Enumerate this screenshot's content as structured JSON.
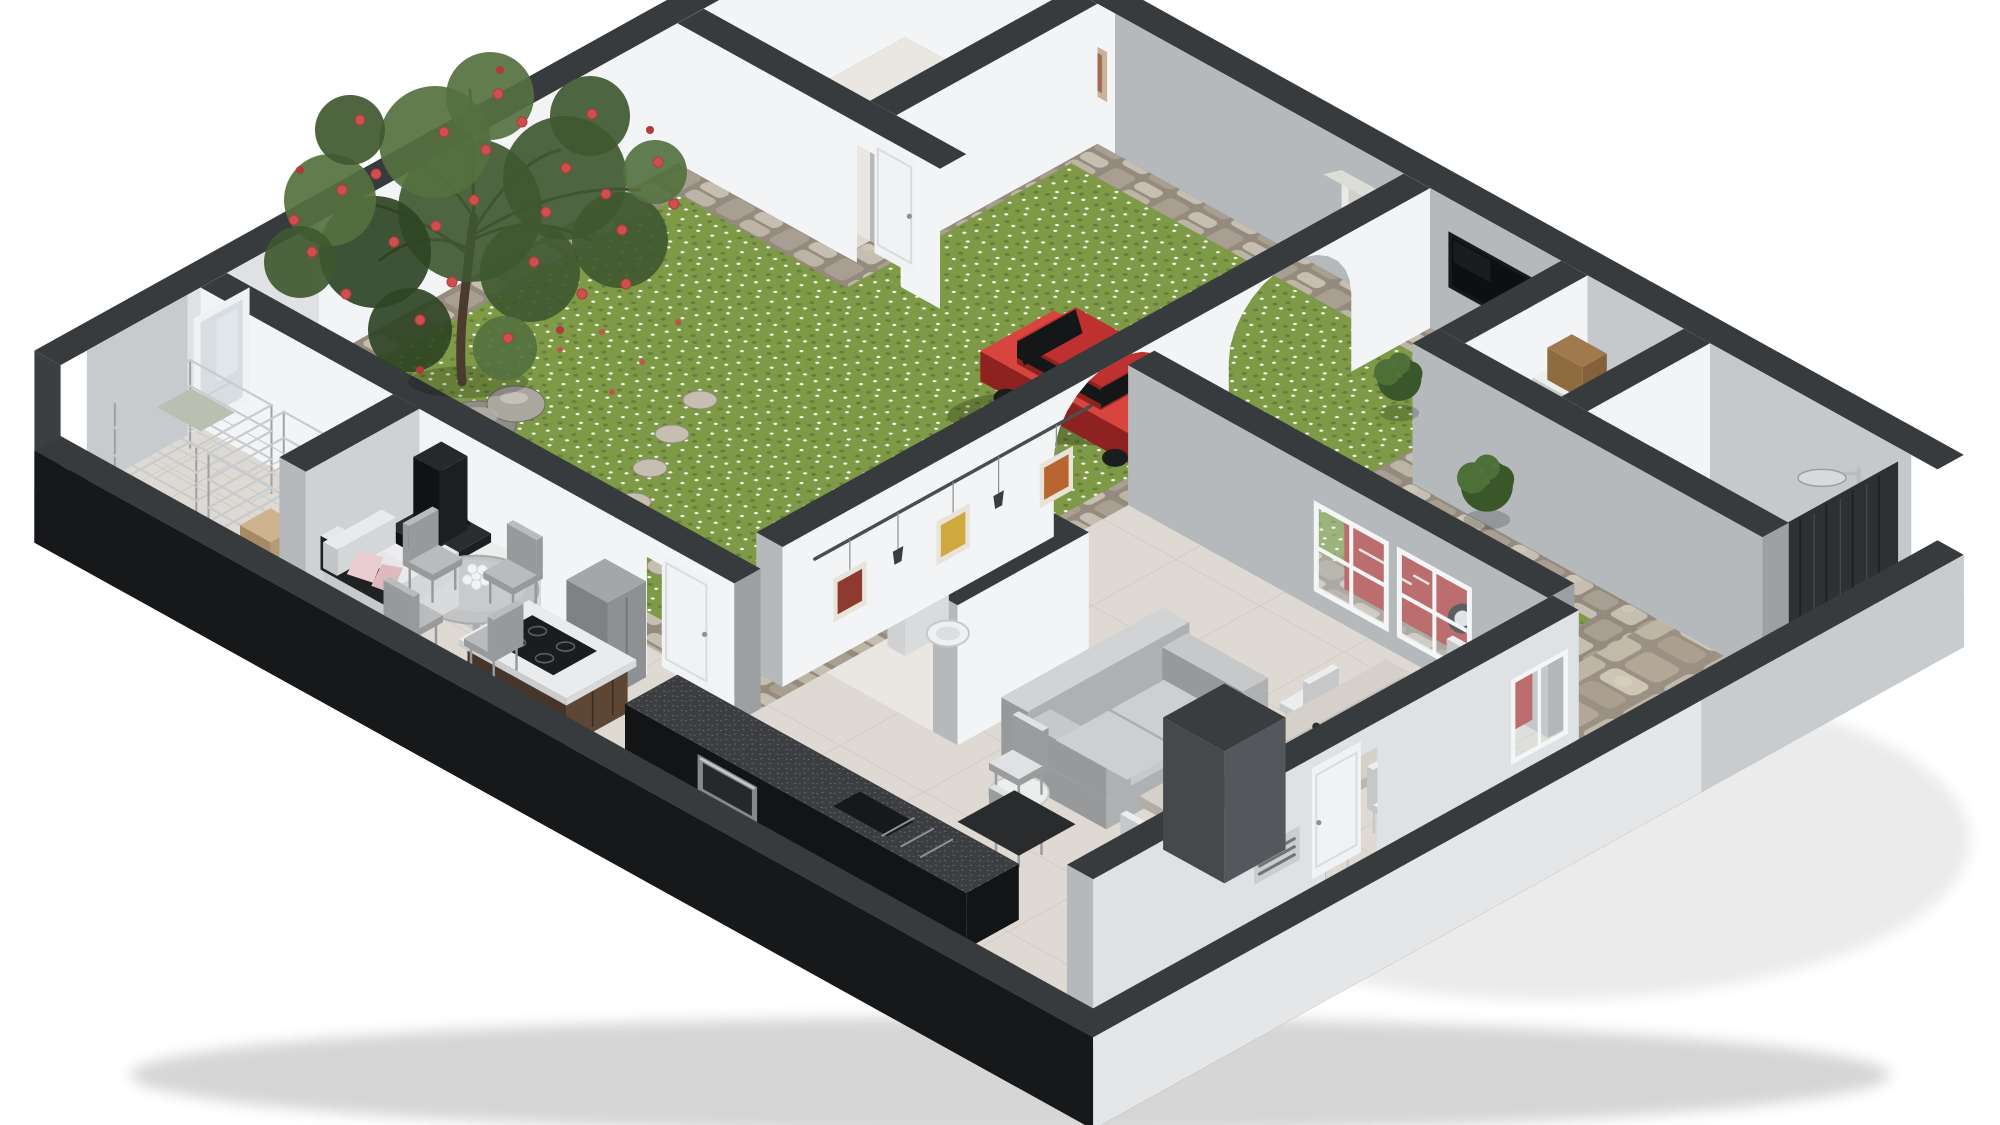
{
  "meta": {
    "type": "isometric-3d-floor-plan-render",
    "description": "Cutaway dollhouse view of an apartment with interior courtyard garden, flowering tree, carport with red car, living-dining room, black kitchen, bathroom with shower and storage room"
  },
  "scene": {
    "rooms": [
      {
        "id": "courtyard-garden"
      },
      {
        "id": "bedroom"
      },
      {
        "id": "closet"
      },
      {
        "id": "bathroom"
      },
      {
        "id": "carport"
      },
      {
        "id": "hallway"
      },
      {
        "id": "wc"
      },
      {
        "id": "living-dining-room"
      },
      {
        "id": "kitchen"
      },
      {
        "id": "storage-room"
      },
      {
        "id": "entry-court"
      }
    ],
    "objects": [
      {
        "id": "flowering-tree"
      },
      {
        "id": "boulders"
      },
      {
        "id": "stepping-stones"
      },
      {
        "id": "red-car"
      },
      {
        "id": "red-banner"
      },
      {
        "id": "plants"
      },
      {
        "id": "wall-tv"
      },
      {
        "id": "wall-shelf-unit"
      },
      {
        "id": "bedroom-picture"
      },
      {
        "id": "arched-wall"
      },
      {
        "id": "framed-pictures"
      },
      {
        "id": "picture-rail"
      },
      {
        "id": "wall-sconces"
      },
      {
        "id": "gray-sofa"
      },
      {
        "id": "dining-table"
      },
      {
        "id": "dining-chairs"
      },
      {
        "id": "candle-holders"
      },
      {
        "id": "entry-mat"
      },
      {
        "id": "bottle-rack"
      },
      {
        "id": "tall-cabinet"
      },
      {
        "id": "entry-door"
      },
      {
        "id": "window-wall"
      },
      {
        "id": "garden-door"
      },
      {
        "id": "interior-door"
      },
      {
        "id": "kitchen-island"
      },
      {
        "id": "induction-hob"
      },
      {
        "id": "black-cabinet-run"
      },
      {
        "id": "built-in-oven"
      },
      {
        "id": "fridge"
      },
      {
        "id": "round-table"
      },
      {
        "id": "flower-vase"
      },
      {
        "id": "kitchen-chairs"
      },
      {
        "id": "white-sofa"
      },
      {
        "id": "pink-pillows"
      },
      {
        "id": "fireplace"
      },
      {
        "id": "shelf-unit"
      },
      {
        "id": "wire-racks"
      },
      {
        "id": "mirror"
      },
      {
        "id": "storage-box"
      },
      {
        "id": "toilet"
      },
      {
        "id": "shower-head"
      },
      {
        "id": "shower-tray"
      },
      {
        "id": "shower-curtain"
      },
      {
        "id": "closet-box"
      },
      {
        "id": "vent-grille"
      }
    ],
    "colors": {
      "bg": "#ffffff",
      "cut": "#383b3e",
      "cutDark": "#2a2d30",
      "plinth": "#141517",
      "wallWhite": "#f3f4f6",
      "wallWhite2": "#e9ebed",
      "wallGray": "#b5b9bb",
      "wallGray2": "#c6c9cb",
      "extLight": "#e4e6e8",
      "extDark": "#17181a",
      "floorTile": "#ded9d2",
      "floorLight": "#eae7e2",
      "bathFloor": "#e8e6e2",
      "grout": "#d0cbc3",
      "grass": "#7e9a46",
      "grassDark": "#5e7834",
      "stone": "#b2ab9f",
      "stoneLight": "#c6bfb1",
      "stoneMid": "#a89f92",
      "stoneDark": "#948b7e",
      "treeLeaf": "#3f5830",
      "treeLeaf2": "#55713f",
      "treeLeaf3": "#2f4424",
      "flowerRed": "#cf4e4e",
      "flowerRed2": "#b03a3c",
      "trunk": "#4a3b2d",
      "rock": "#8f8c85",
      "rockDark": "#6e6c66",
      "rockLight": "#aaa79f",
      "carRed": "#bf312e",
      "carRed2": "#d8453f",
      "carDark": "#8e2220",
      "carGlass": "#141618",
      "tv": "#17191b",
      "tvScreen": "#0d0f11",
      "shelfWhite": "#e9eae5",
      "shelfShadow": "#b9bab2",
      "sofaGray": "#c7c8ca",
      "sofaLight": "#d2d3d5",
      "sofaSide": "#aeb0b2",
      "sofaDark": "#97999b",
      "tableWood": "#d5d1ca",
      "tableEdge": "#bcb8b1",
      "chairWhite": "#ecedee",
      "chairShadow": "#c5c7c9",
      "chairGray": "#b9bbbd",
      "islandWood": "#5d4634",
      "islandWoodDark": "#46352a",
      "counterWhite": "#eaebec",
      "hob": "#1a1c1e",
      "runBlack": "#121416",
      "counterTop": "#3b3d40",
      "oven": "#85898c",
      "ovenGlass": "#26282b",
      "fireBlack": "#1c1e20",
      "fireDark": "#101214",
      "fridge": "#a3a7aa",
      "fridgeDark": "#8d9194",
      "rackMetal": "#c9ccce",
      "rackMetalDark": "#9da1a4",
      "rackWood": "#8a6a48",
      "rackWoodDark": "#6e5338",
      "mirror": "#d7dde0",
      "mat": "#292b2d",
      "column": "#54575b",
      "columnSide": "#46484c",
      "columnTop": "#3a3c3f",
      "banner": "#ab3431",
      "curtain": "#2e3032",
      "doorWhite": "#f1f2f3",
      "doorFrame": "#d9dbdc",
      "knob": "#8e9194",
      "toilet": "#eef0f1",
      "plant": "#4c7038",
      "plantDark": "#3a5729",
      "glass": "rgba(223,234,240,0.32)",
      "artRed": "#8e3a2e",
      "artYellow": "#cfa93e",
      "artOrange": "#b8652f",
      "frameWood": "#e8e4da",
      "railDark": "#4a4c4e",
      "sconce": "#3a3c3e",
      "boxBrown": "#a07a4c",
      "boxBrownDark": "#84613a",
      "shadow": "rgba(0,0,0,0.16)",
      "petal": "#c94a4a"
    }
  }
}
